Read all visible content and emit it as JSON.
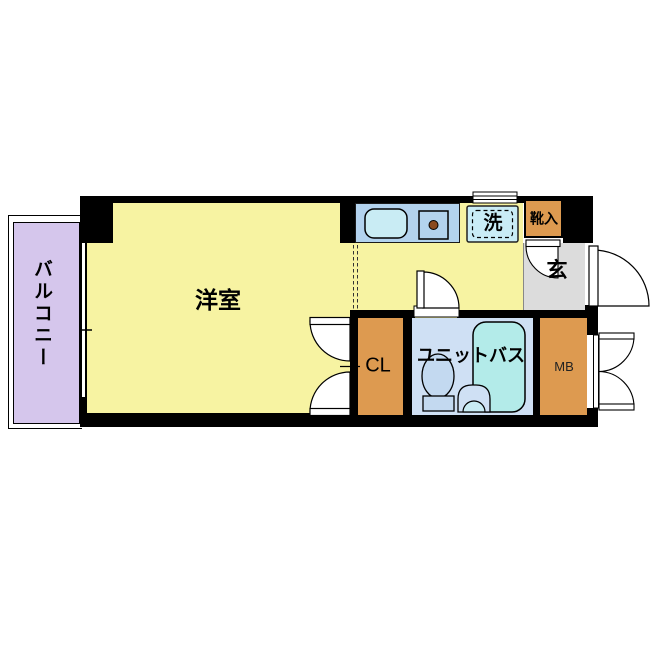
{
  "diagram_type": "japanese-apartment-floor-plan",
  "rooms": {
    "balcony": {
      "label": "バルコニー",
      "color": "#d5c6ec"
    },
    "western_room": {
      "label": "洋室",
      "color": "#f7f3a2"
    },
    "entrance": {
      "label": "玄",
      "color": "#dcdcdc"
    },
    "shoe_box": {
      "label": "靴入",
      "color": "#dd9a50"
    },
    "washer_space": {
      "label": "洗",
      "color": "#c9ecf6"
    },
    "closet": {
      "label": "CL",
      "color": "#dd9a50"
    },
    "unit_bath": {
      "label": "ユニットバス",
      "color": "#cfe0f4"
    },
    "meter_box": {
      "label": "MB",
      "color": "#dd9a50"
    }
  },
  "fixtures": [
    "kitchen-counter",
    "kitchen-sink",
    "single-burner-stove",
    "louver-window",
    "washing-machine-pan",
    "bathtub",
    "toilet",
    "wash-basin",
    "entrance-door-swing",
    "unit-bath-door-swing",
    "closet-double-door-swing",
    "meter-box-double-door-swing",
    "shoe-box-door-swing",
    "sliding-window"
  ],
  "colors": {
    "wall": "#000000",
    "kitchen_counter": "#b3d3ee",
    "sink": "#c9ecf4",
    "bathtub": "#b3ebe9",
    "toilet": "#c3d9f0",
    "background": "#ffffff"
  }
}
